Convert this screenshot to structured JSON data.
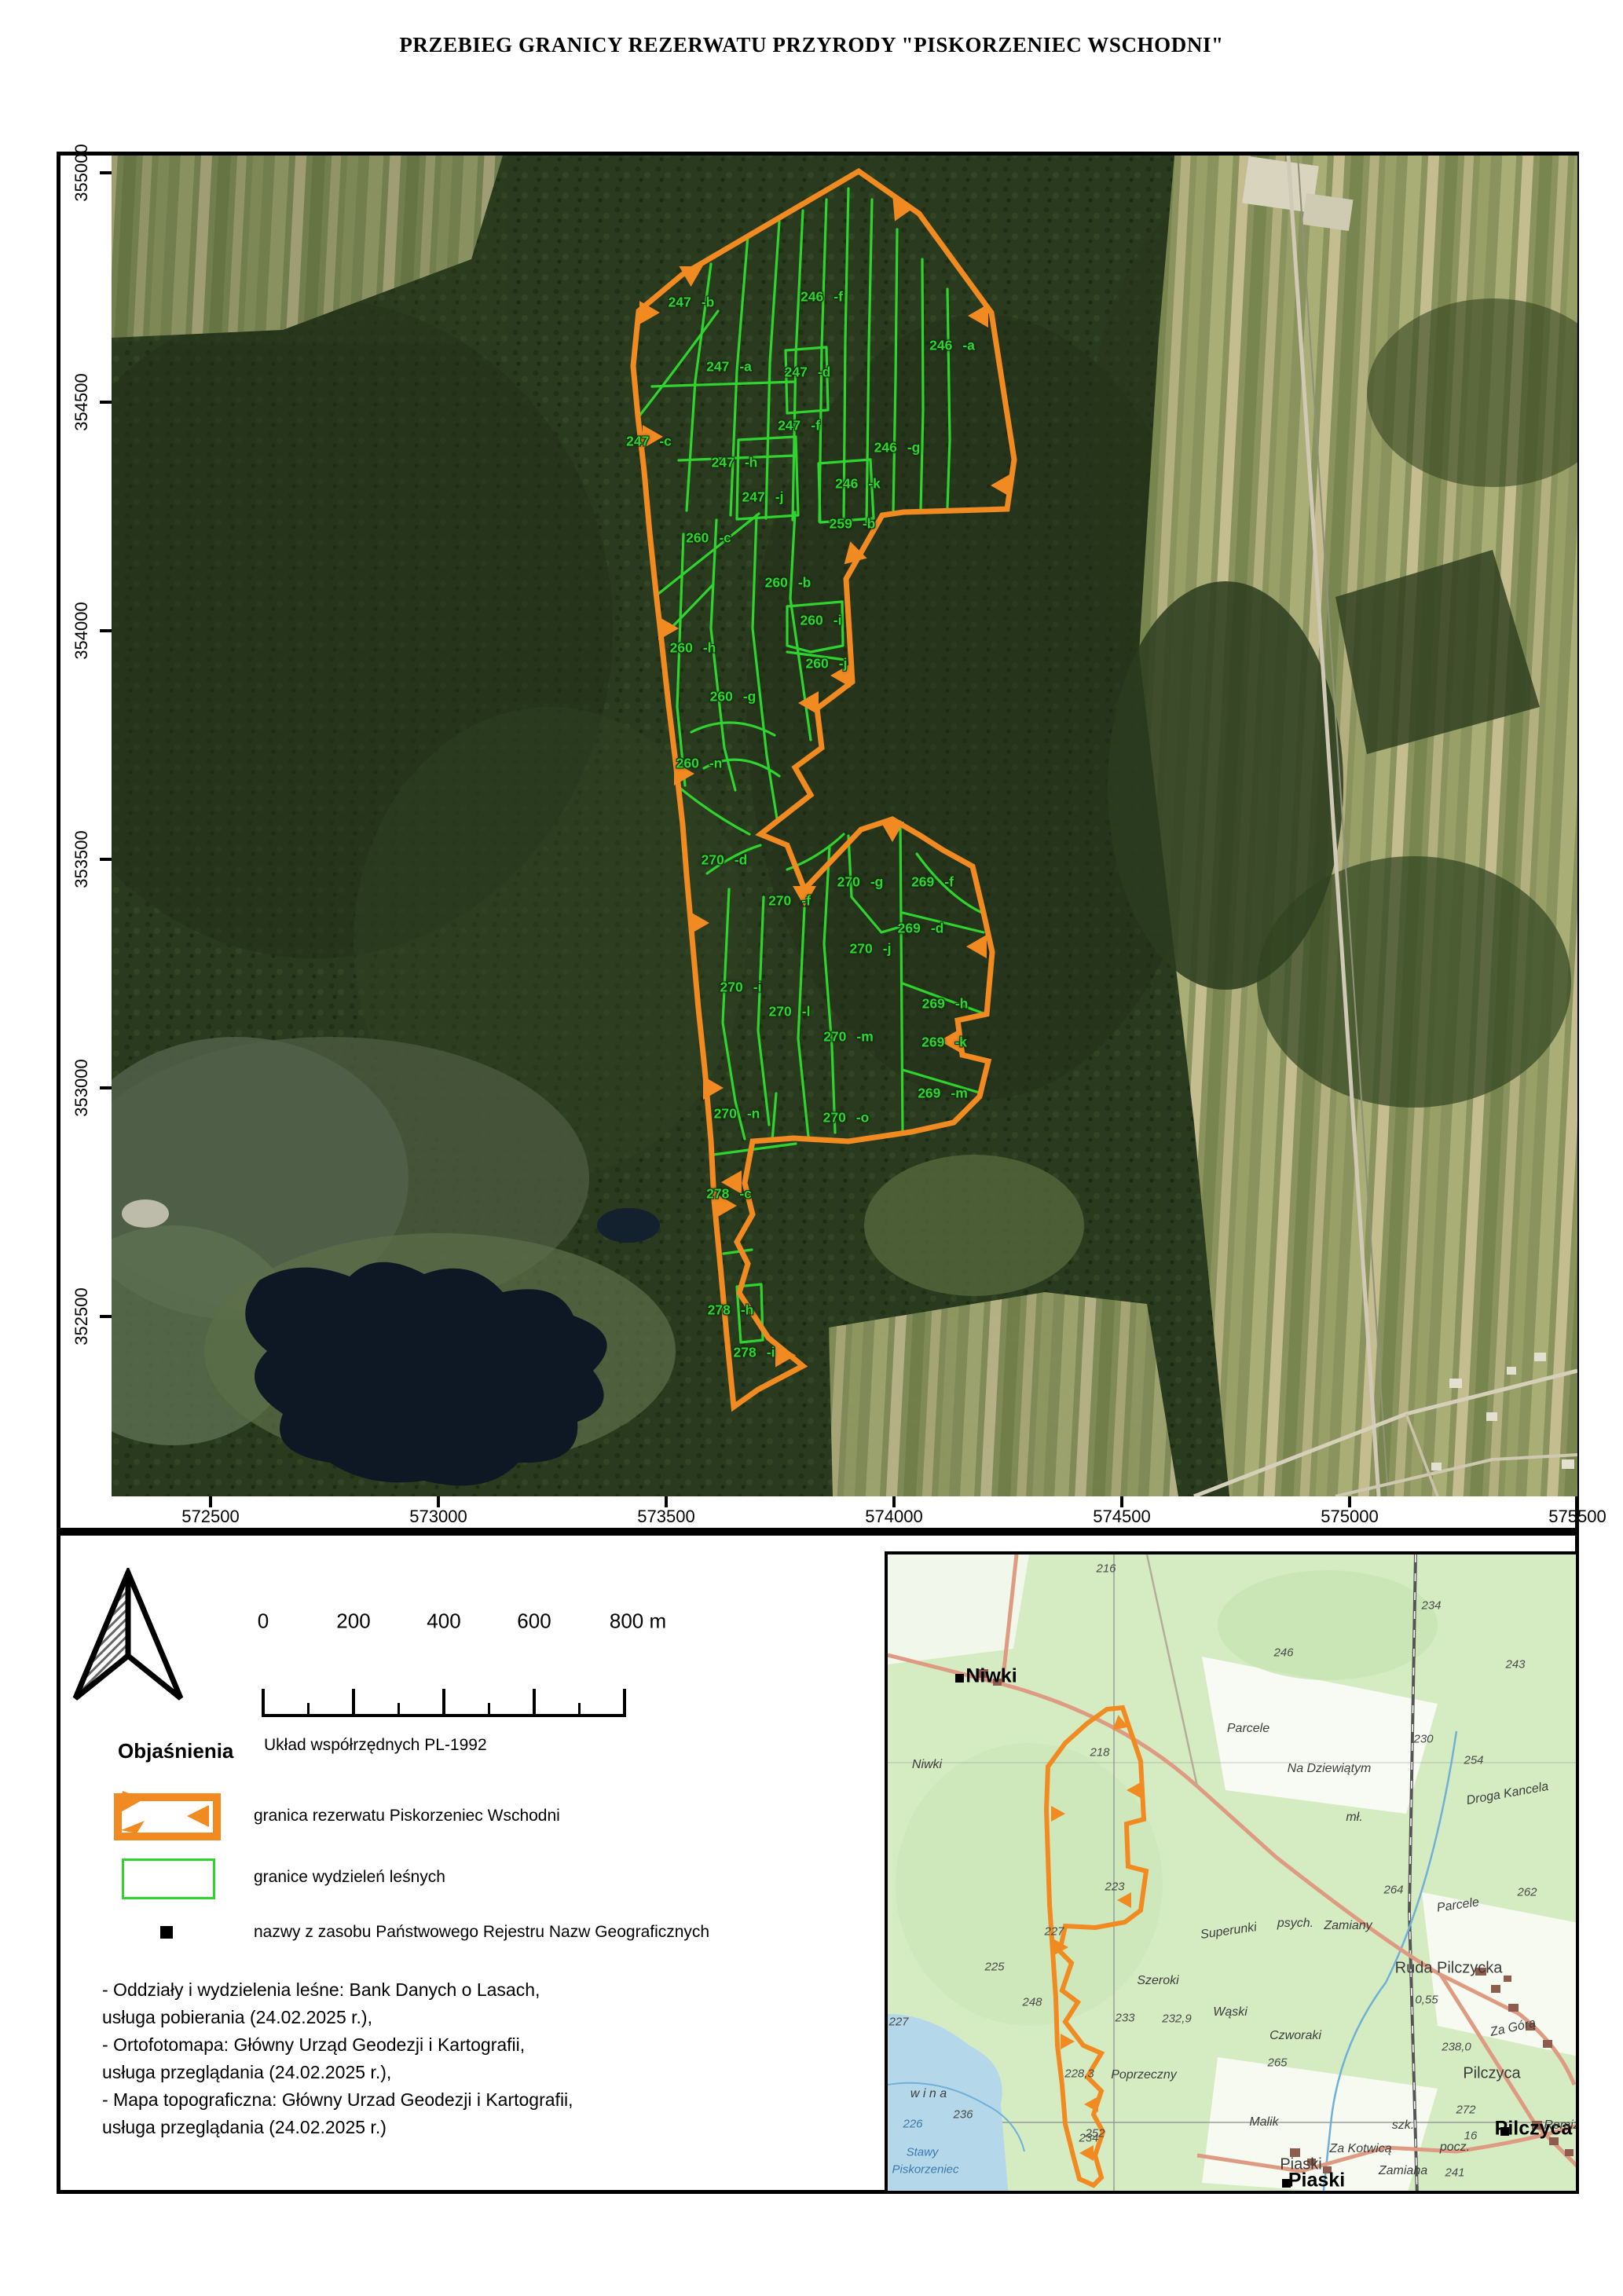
{
  "title": "PRZEBIEG GRANICY REZERWATU PRZYRODY \"PISKORZENIEC WSCHODNI\"",
  "colors": {
    "reserve-orange": "#F08A21",
    "parcel-green": "#2FD42F",
    "inset-green": "#d5ecc3",
    "forest-dark": "#2a3a1e",
    "water-blue": "#b4d8ea"
  },
  "map": {
    "y_ticks": [
      {
        "t": "355000",
        "y": 220
      },
      {
        "t": "354500",
        "y": 512
      },
      {
        "t": "354000",
        "y": 803
      },
      {
        "t": "353500",
        "y": 1094
      },
      {
        "t": "353000",
        "y": 1385
      },
      {
        "t": "352500",
        "y": 1676
      }
    ],
    "x_ticks": [
      {
        "t": "572500",
        "x": 268
      },
      {
        "t": "573000",
        "x": 558
      },
      {
        "t": "573500",
        "x": 848
      },
      {
        "t": "574000",
        "x": 1138
      },
      {
        "t": "574500",
        "x": 1428
      },
      {
        "t": "575000",
        "x": 1718
      },
      {
        "t": "575500",
        "x": 2008
      }
    ],
    "parcels": [
      {
        "n": "247",
        "s": "-b",
        "x": 880,
        "y": 385
      },
      {
        "n": "246",
        "s": "-f",
        "x": 1046,
        "y": 378
      },
      {
        "n": "247",
        "s": "-a",
        "x": 928,
        "y": 467
      },
      {
        "n": "247",
        "s": "-d",
        "x": 1028,
        "y": 474
      },
      {
        "n": "246",
        "s": "-a",
        "x": 1212,
        "y": 440
      },
      {
        "n": "247",
        "s": "-c",
        "x": 826,
        "y": 562
      },
      {
        "n": "247",
        "s": "-f",
        "x": 1017,
        "y": 542
      },
      {
        "n": "246",
        "s": "-g",
        "x": 1142,
        "y": 570
      },
      {
        "n": "247",
        "s": "-h",
        "x": 935,
        "y": 589
      },
      {
        "n": "246",
        "s": "-k",
        "x": 1092,
        "y": 616
      },
      {
        "n": "247",
        "s": "-j",
        "x": 971,
        "y": 633
      },
      {
        "n": "259",
        "s": "-b",
        "x": 1085,
        "y": 667
      },
      {
        "n": "260",
        "s": "-c",
        "x": 902,
        "y": 685
      },
      {
        "n": "260",
        "s": "-b",
        "x": 1003,
        "y": 742
      },
      {
        "n": "260",
        "s": "-i",
        "x": 1045,
        "y": 790
      },
      {
        "n": "260",
        "s": "-h",
        "x": 882,
        "y": 825
      },
      {
        "n": "260",
        "s": "-j",
        "x": 1052,
        "y": 845
      },
      {
        "n": "260",
        "s": "-g",
        "x": 933,
        "y": 887
      },
      {
        "n": "260",
        "s": "-n",
        "x": 890,
        "y": 972
      },
      {
        "n": "270",
        "s": "-d",
        "x": 922,
        "y": 1095
      },
      {
        "n": "270",
        "s": "-g",
        "x": 1095,
        "y": 1123
      },
      {
        "n": "269",
        "s": "-f",
        "x": 1187,
        "y": 1123
      },
      {
        "n": "270",
        "s": "-f",
        "x": 1005,
        "y": 1147
      },
      {
        "n": "269",
        "s": "-d",
        "x": 1172,
        "y": 1182
      },
      {
        "n": "270",
        "s": "-j",
        "x": 1108,
        "y": 1208
      },
      {
        "n": "270",
        "s": "-i",
        "x": 943,
        "y": 1257
      },
      {
        "n": "269",
        "s": "-h",
        "x": 1203,
        "y": 1278
      },
      {
        "n": "270",
        "s": "-l",
        "x": 1005,
        "y": 1288
      },
      {
        "n": "270",
        "s": "-m",
        "x": 1080,
        "y": 1320
      },
      {
        "n": "269",
        "s": "-k",
        "x": 1202,
        "y": 1327
      },
      {
        "n": "269",
        "s": "-m",
        "x": 1200,
        "y": 1392
      },
      {
        "n": "270",
        "s": "-n",
        "x": 938,
        "y": 1418
      },
      {
        "n": "270",
        "s": "-o",
        "x": 1077,
        "y": 1423
      },
      {
        "n": "278",
        "s": "-c",
        "x": 928,
        "y": 1520
      },
      {
        "n": "278",
        "s": "-h",
        "x": 930,
        "y": 1668
      },
      {
        "n": "278",
        "s": "-i",
        "x": 960,
        "y": 1722
      }
    ]
  },
  "scalebar": {
    "labels": [
      {
        "t": "0",
        "x": 335
      },
      {
        "t": "200",
        "x": 450
      },
      {
        "t": "400",
        "x": 565
      },
      {
        "t": "600",
        "x": 680
      },
      {
        "t": "800 m",
        "x": 812
      }
    ],
    "crs": "Układ współrzędnych PL-1992"
  },
  "legend": {
    "heading": "Objaśnienia",
    "items": [
      {
        "label": "granica rezerwatu Piskorzeniec Wschodni"
      },
      {
        "label": "granice wydzieleń leśnych"
      },
      {
        "label": "nazwy z zasobu Państwowego Rejestru Nazw Geograficznych"
      }
    ]
  },
  "sources": [
    "- Oddziały i wydzielenia leśne: Bank Danych o Lasach,",
    "usługa pobierania (24.02.2025 r.),",
    "- Ortofotomapa: Główny Urząd Geodezji i Kartografii,",
    "usługa przeglądania (24.02.2025 r.),",
    "- Mapa topograficzna: Główny Urzad Geodezji i Kartografii,",
    "usługa przeglądania (24.02.2025 r.)"
  ],
  "inset": {
    "labels": [
      {
        "t": "Niwki",
        "x": 132,
        "y": 155,
        "cls": "prng"
      },
      {
        "t": "Pilczyca",
        "x": 822,
        "y": 731,
        "cls": "prng"
      },
      {
        "t": "Piaski",
        "x": 546,
        "y": 797,
        "cls": "prng"
      },
      {
        "t": "Ruda Pilczycka",
        "x": 714,
        "y": 527,
        "cls": "town"
      },
      {
        "t": "Pilczyca",
        "x": 769,
        "y": 661,
        "cls": "town"
      },
      {
        "t": "Piaski",
        "x": 526,
        "y": 777,
        "cls": "town"
      },
      {
        "t": "Niwki",
        "x": 50,
        "y": 268,
        "cls": "name"
      },
      {
        "t": "Parcele",
        "x": 459,
        "y": 222,
        "cls": "name"
      },
      {
        "t": "Na Dziewiątym",
        "x": 562,
        "y": 273,
        "cls": "name"
      },
      {
        "t": "Droga Kancela",
        "x": 789,
        "y": 305,
        "cls": "name",
        "rot": -10
      },
      {
        "t": "mł.",
        "x": 594,
        "y": 335,
        "cls": "name"
      },
      {
        "t": "Szeroki",
        "x": 344,
        "y": 543,
        "cls": "name"
      },
      {
        "t": "Wąski",
        "x": 436,
        "y": 583,
        "cls": "name"
      },
      {
        "t": "psych.",
        "x": 519,
        "y": 470,
        "cls": "name"
      },
      {
        "t": "Czworaki",
        "x": 519,
        "y": 613,
        "cls": "name"
      },
      {
        "t": "Poprzeczny",
        "x": 326,
        "y": 663,
        "cls": "name"
      },
      {
        "t": "Malik",
        "x": 479,
        "y": 723,
        "cls": "name"
      },
      {
        "t": "Za Kotwicą",
        "x": 602,
        "y": 757,
        "cls": "name"
      },
      {
        "t": "Za Górą",
        "x": 796,
        "y": 603,
        "cls": "name",
        "rot": -12
      },
      {
        "t": "Remizy",
        "x": 862,
        "y": 727,
        "cls": "name"
      },
      {
        "t": "Superunki",
        "x": 434,
        "y": 480,
        "cls": "name",
        "rot": -8
      },
      {
        "t": "Zamiany",
        "x": 586,
        "y": 473,
        "cls": "name"
      },
      {
        "t": "Parcele",
        "x": 726,
        "y": 447,
        "cls": "name",
        "rot": -8
      },
      {
        "t": "Zamiana",
        "x": 656,
        "y": 785,
        "cls": "name"
      },
      {
        "t": "szk.",
        "x": 656,
        "y": 727,
        "cls": "name"
      },
      {
        "t": "pocz.",
        "x": 722,
        "y": 755,
        "cls": "name"
      },
      {
        "t": "w i n a",
        "x": 52,
        "y": 687,
        "cls": "name"
      },
      {
        "t": "216",
        "x": 278,
        "y": 18,
        "cls": "num"
      },
      {
        "t": "234",
        "x": 692,
        "y": 65,
        "cls": "num"
      },
      {
        "t": "246",
        "x": 504,
        "y": 125,
        "cls": "num"
      },
      {
        "t": "243",
        "x": 799,
        "y": 140,
        "cls": "num"
      },
      {
        "t": "218",
        "x": 270,
        "y": 252,
        "cls": "num"
      },
      {
        "t": "230",
        "x": 682,
        "y": 235,
        "cls": "num"
      },
      {
        "t": "254",
        "x": 746,
        "y": 262,
        "cls": "num"
      },
      {
        "t": "264",
        "x": 644,
        "y": 427,
        "cls": "num"
      },
      {
        "t": "262",
        "x": 814,
        "y": 430,
        "cls": "num"
      },
      {
        "t": "223",
        "x": 289,
        "y": 423,
        "cls": "num"
      },
      {
        "t": "227",
        "x": 212,
        "y": 480,
        "cls": "num"
      },
      {
        "t": "225",
        "x": 136,
        "y": 525,
        "cls": "num"
      },
      {
        "t": "227",
        "x": 14,
        "y": 595,
        "cls": "num"
      },
      {
        "t": "233",
        "x": 302,
        "y": 590,
        "cls": "num"
      },
      {
        "t": "232,9",
        "x": 368,
        "y": 591,
        "cls": "num"
      },
      {
        "t": "265",
        "x": 496,
        "y": 647,
        "cls": "num"
      },
      {
        "t": "0,55",
        "x": 686,
        "y": 567,
        "cls": "num"
      },
      {
        "t": "238,0",
        "x": 724,
        "y": 627,
        "cls": "num"
      },
      {
        "t": "272",
        "x": 736,
        "y": 707,
        "cls": "num"
      },
      {
        "t": "236",
        "x": 96,
        "y": 713,
        "cls": "num"
      },
      {
        "t": "234",
        "x": 256,
        "y": 743,
        "cls": "num"
      },
      {
        "t": "248",
        "x": 184,
        "y": 570,
        "cls": "num"
      },
      {
        "t": "228,3",
        "x": 244,
        "y": 661,
        "cls": "num"
      },
      {
        "t": "252",
        "x": 264,
        "y": 737,
        "cls": "num"
      },
      {
        "t": "16",
        "x": 742,
        "y": 740,
        "cls": "num"
      },
      {
        "t": "241",
        "x": 722,
        "y": 787,
        "cls": "num"
      },
      {
        "t": "226",
        "x": 32,
        "y": 725,
        "cls": "water"
      },
      {
        "t": "Stawy",
        "x": 44,
        "y": 761,
        "cls": "water"
      },
      {
        "t": "Piskorzeniec",
        "x": 48,
        "y": 783,
        "cls": "water"
      }
    ]
  }
}
